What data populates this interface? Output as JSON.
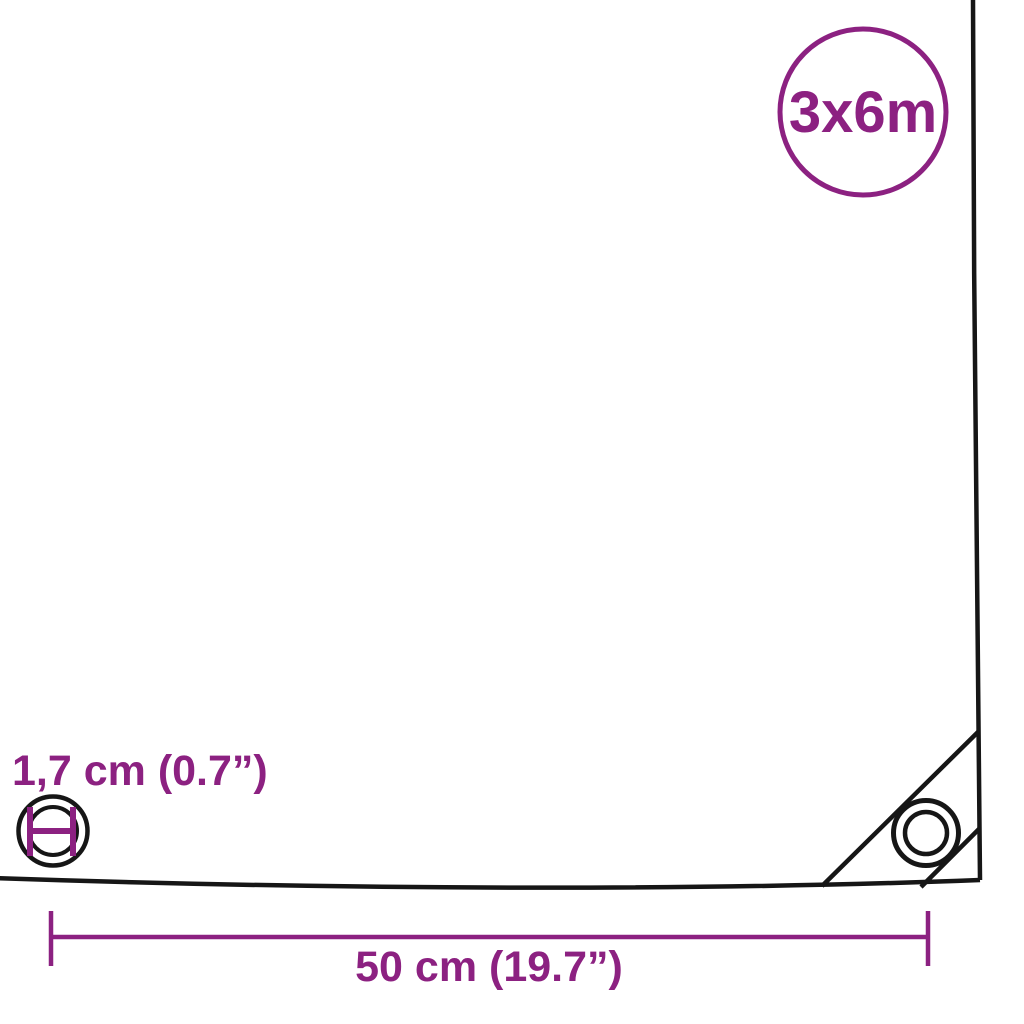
{
  "badge": {
    "label": "3x6m"
  },
  "annotations": {
    "grommet_diameter_label": "1,7 cm (0.7”)",
    "grommet_spacing_label": "50 cm (19.7”)"
  },
  "colors": {
    "accent": "#8C2181",
    "outline": "#161616",
    "background": "#FFFFFF"
  }
}
